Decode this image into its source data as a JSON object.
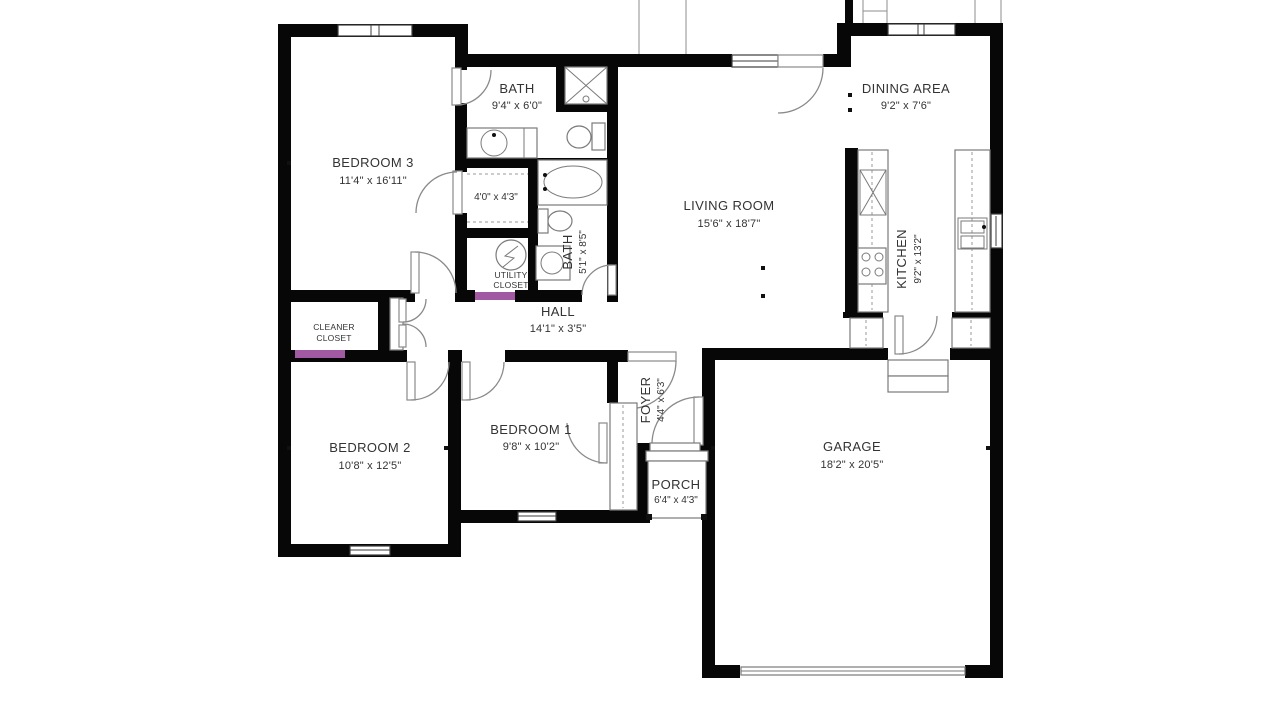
{
  "background": "#ffffff",
  "colors": {
    "wall": "#070707",
    "fixture_line": "#7a7a7a",
    "text": "#333333",
    "door_accent": "#a159a1"
  },
  "rooms": {
    "bedroom3": {
      "label": "BEDROOM 3",
      "dims": "11'4\" x 16'11\""
    },
    "bath_main": {
      "label": "BATH",
      "dims": "9'4\" x 6'0\""
    },
    "closet_bedroom3": {
      "dims": "4'0\" x 4'3\""
    },
    "bath_hall": {
      "label": "BATH",
      "dims": "5'1\" x 8'5\""
    },
    "utility_closet": {
      "label_line1": "UTILITY",
      "label_line2": "CLOSET"
    },
    "hall": {
      "label": "HALL",
      "dims": "14'1\" x 3'5\""
    },
    "cleaner_closet": {
      "label_line1": "CLEANER",
      "label_line2": "CLOSET"
    },
    "bedroom2": {
      "label": "BEDROOM 2",
      "dims": "10'8\" x 12'5\""
    },
    "bedroom1": {
      "label": "BEDROOM 1",
      "dims": "9'8\" x 10'2\""
    },
    "foyer": {
      "label": "FOYER",
      "dims": "4'4\" x 6'3\""
    },
    "porch": {
      "label": "PORCH",
      "dims": "6'4\" x 4'3\""
    },
    "living_room": {
      "label": "LIVING ROOM",
      "dims": "15'6\" x 18'7\""
    },
    "dining_area": {
      "label": "DINING AREA",
      "dims": "9'2\" x 7'6\""
    },
    "kitchen": {
      "label": "KITCHEN",
      "dims": "9'2\" x 13'2\""
    },
    "garage": {
      "label": "GARAGE",
      "dims": "18'2\" x 20'5\""
    }
  },
  "fixtures": [
    "shower",
    "vanity-sink",
    "toilet",
    "bathtub",
    "pedestal-sink",
    "water-heater",
    "refrigerator",
    "stove",
    "kitchen-sink",
    "pantry",
    "garage-steps",
    "garage-door",
    "window",
    "door",
    "closet-rod"
  ]
}
